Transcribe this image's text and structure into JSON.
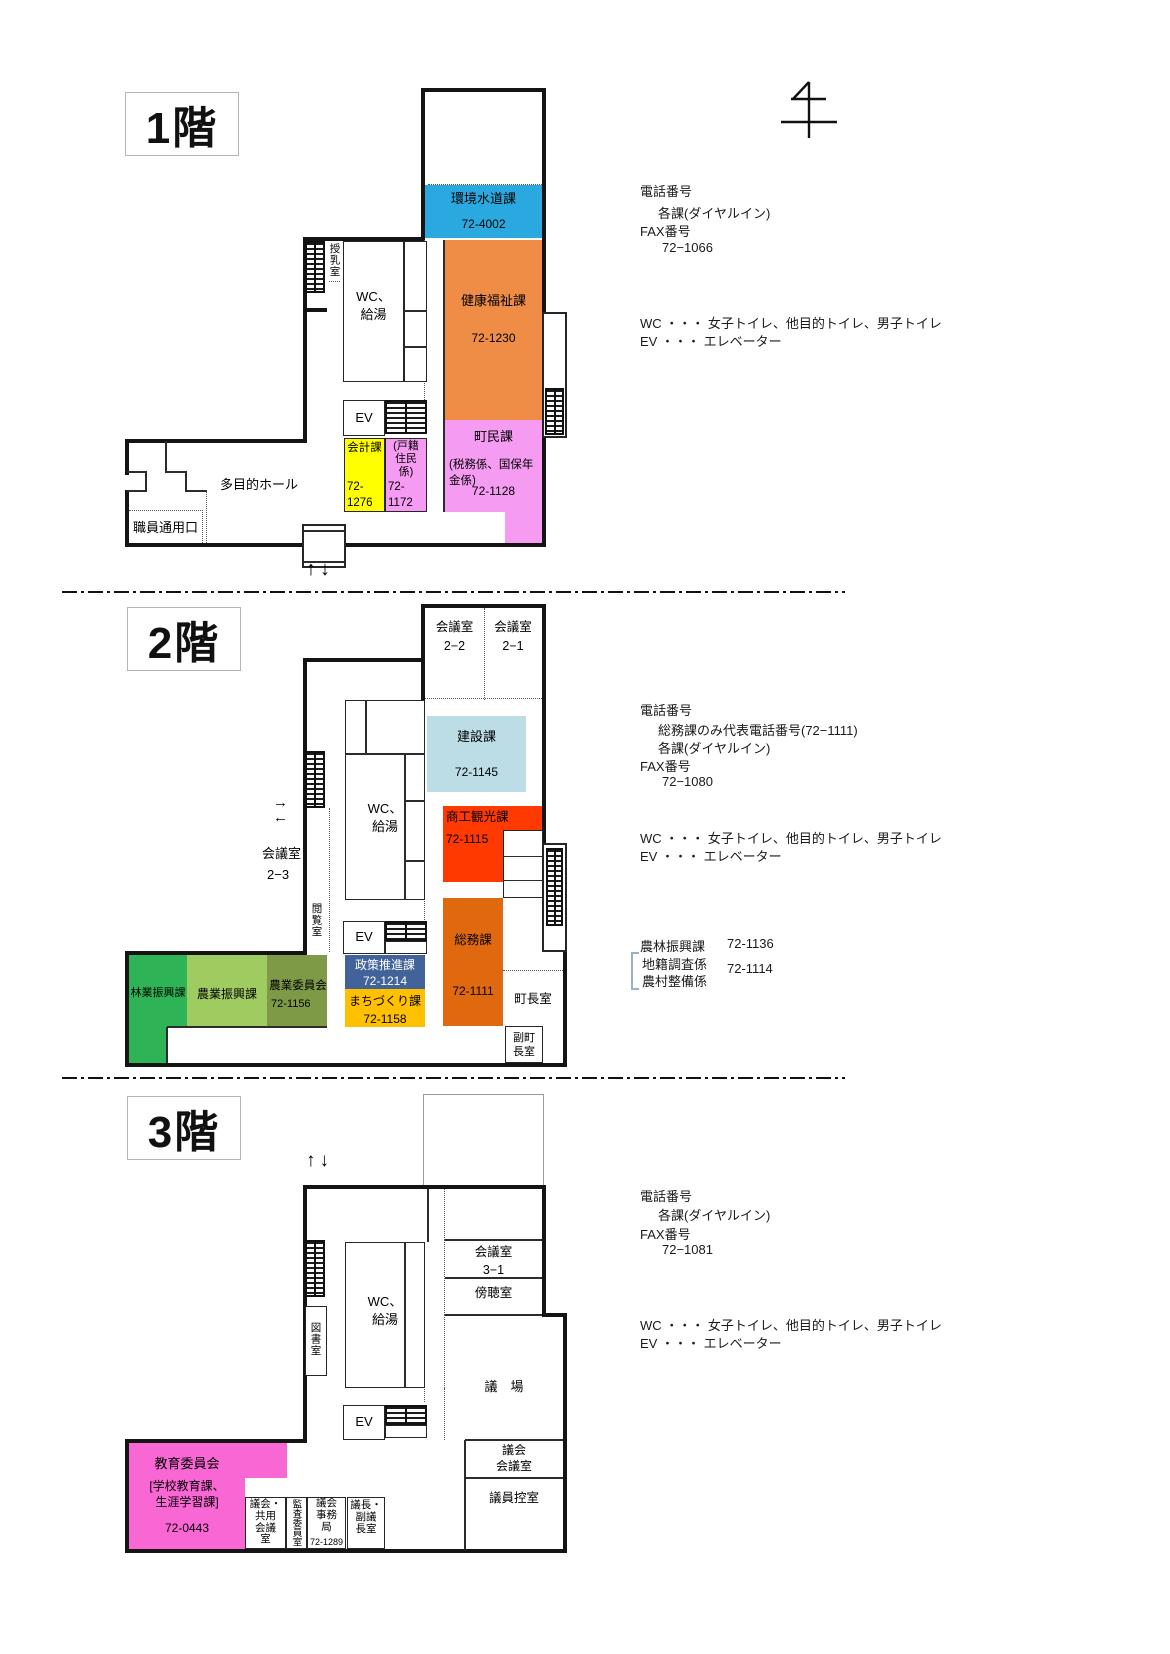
{
  "colors": {
    "kankyo": "#29A9E0",
    "kenko": "#EF8C45",
    "pink": "#F59BF2",
    "yellow": "#FFFF00",
    "kensetsu": "#BCDCE6",
    "shoko": "#FF3A00",
    "somu": "#E0690F",
    "seisaku": "#41639A",
    "machi": "#FFC000",
    "ringyo": "#2EB456",
    "nogyo": "#9FCC60",
    "noi": "#7F9A47",
    "kyoiku": "#F967D4"
  },
  "arrows": {
    "updown": "↑↓",
    "right": "→",
    "left": "←"
  },
  "floor1": {
    "title": "1階",
    "rooms": {
      "kankyo_name": "環境水道課",
      "kankyo_tel": "72-4002",
      "kenko_name": "健康福祉課",
      "kenko_tel": "72-1230",
      "chomin_name": "町民課",
      "chomin_sub": "(税務係、国保年金係)",
      "chomin_tel": "72-1128",
      "kaikei_name": "会計課",
      "kaikei_tel": "72-\n 1276",
      "koseki_name": "(戸籍\n住民\n係)",
      "koseki_tel": "72-\n 1172",
      "ev": "EV",
      "wc": "WC、\n給湯",
      "junyu": "授乳室",
      "hall": "多目的ホール",
      "entrance": "職員通用口"
    },
    "info": {
      "phone_label": "電話番号",
      "phone_line1": "各課(ダイヤルイン)",
      "fax_label": "FAX番号",
      "fax_number": "72−1066",
      "wc_note": "WC ・・・ 女子トイレ、他目的トイレ、男子トイレ",
      "ev_note": "EV ・・・ エレベーター"
    }
  },
  "floor2": {
    "title": "2階",
    "rooms": {
      "kaigi22": "会議室\n2−2",
      "kaigi21": "会議室\n2−1",
      "kensetsu_name": "建設課",
      "kensetsu_tel": "72-1145",
      "shoko_name": "商工観光課",
      "shoko_tel": "72-1115",
      "somu_name": "総務課",
      "somu_tel": "72-1111",
      "seisaku_name": "政策推進課",
      "seisaku_tel": "72-1214",
      "machi_name": "まちづくり課",
      "machi_tel": "72-1158",
      "ringyo": "林業振興課",
      "nogyo": "農業振興課",
      "noi_name": "農業委員会",
      "noi_tel": "72-1156",
      "chocho": "町長室",
      "fuku": "副町\n長室",
      "kaigi23_l1": "会議室",
      "kaigi23_l2": "2−3",
      "etsuran": "閲覧室",
      "wc": "WC、\n給湯",
      "ev": "EV"
    },
    "info": {
      "phone_label": "電話番号",
      "phone_line1": "総務課のみ代表電話番号(72−1111)",
      "phone_line2": "各課(ダイヤルイン)",
      "fax_label": "FAX番号",
      "fax_number": "72−1080",
      "wc_note": "WC ・・・ 女子トイレ、他目的トイレ、男子トイレ",
      "ev_note": "EV ・・・ エレベーター",
      "norin_label": "農林振興課",
      "norin_tel": "72-1136",
      "chiseki_label": "地籍調査係",
      "noson_label": "農村整備係",
      "chiseki_tel": "72-1114"
    }
  },
  "floor3": {
    "title": "3階",
    "rooms": {
      "kaigi31": "会議室\n3−1",
      "bocho": "傍聴室",
      "gijo": "議　場",
      "gikai_kaigi": "議会\n会議室",
      "giin": "議員控室",
      "kyoiku_name": "教育委員会",
      "kyoiku_sub": "[学校教育課、\n生涯学習課]",
      "kyoiku_tel": "72-0443",
      "kyoyo": "議会・\n共用\n会議\n室",
      "kansa": "監査委員室",
      "jimu_name": "議会\n事務\n局",
      "jimu_tel": "72-1289",
      "gicho": "議長・\n副議\n長室",
      "tosho": "図書室",
      "wc": "WC、\n給湯",
      "ev": "EV"
    },
    "info": {
      "phone_label": "電話番号",
      "phone_line1": "各課(ダイヤルイン)",
      "fax_label": "FAX番号",
      "fax_number": "72−1081",
      "wc_note": "WC ・・・ 女子トイレ、他目的トイレ、男子トイレ",
      "ev_note": "EV ・・・ エレベーター"
    }
  }
}
